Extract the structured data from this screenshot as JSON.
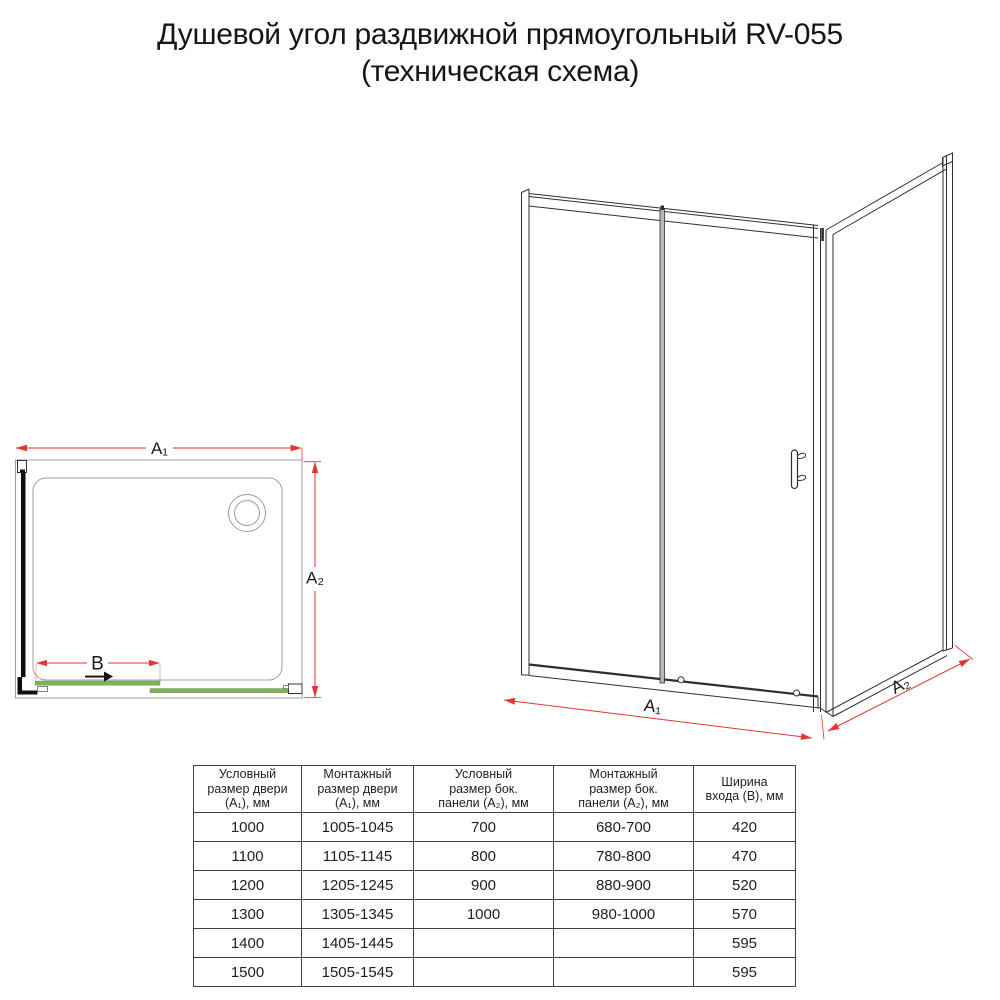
{
  "title": {
    "line1": "Душевой угол раздвижной прямоугольный RV-055",
    "line2": "(техническая схема)"
  },
  "top_view": {
    "width_label": "A₁",
    "depth_label": "A₂",
    "entry_label": "B"
  },
  "front_view": {
    "width_label": "A₁",
    "depth_label": "A₂"
  },
  "table": {
    "headers": [
      "Условный\nразмер двери\n(A₁), мм",
      "Монтажный\nразмер двери\n(A₁), мм",
      "Условный\nразмер бок.\nпанели (A₂), мм",
      "Монтажный\nразмер бок.\nпанели (A₂), мм",
      "Ширина\nвхода (B), мм"
    ],
    "rows": [
      [
        "1000",
        "1005-1045",
        "700",
        "680-700",
        "420"
      ],
      [
        "1100",
        "1105-1145",
        "800",
        "780-800",
        "470"
      ],
      [
        "1200",
        "1205-1245",
        "900",
        "880-900",
        "520"
      ],
      [
        "1300",
        "1305-1345",
        "1000",
        "980-1000",
        "570"
      ],
      [
        "1400",
        "1405-1445",
        "",
        "",
        "595"
      ],
      [
        "1500",
        "1505-1545",
        "",
        "",
        "595"
      ]
    ]
  },
  "colors": {
    "dimension_red": "#e53530",
    "glass_green": "#7eb457",
    "drawing_gray": "#9c9c9c",
    "line_dark": "#2f2f2f"
  }
}
